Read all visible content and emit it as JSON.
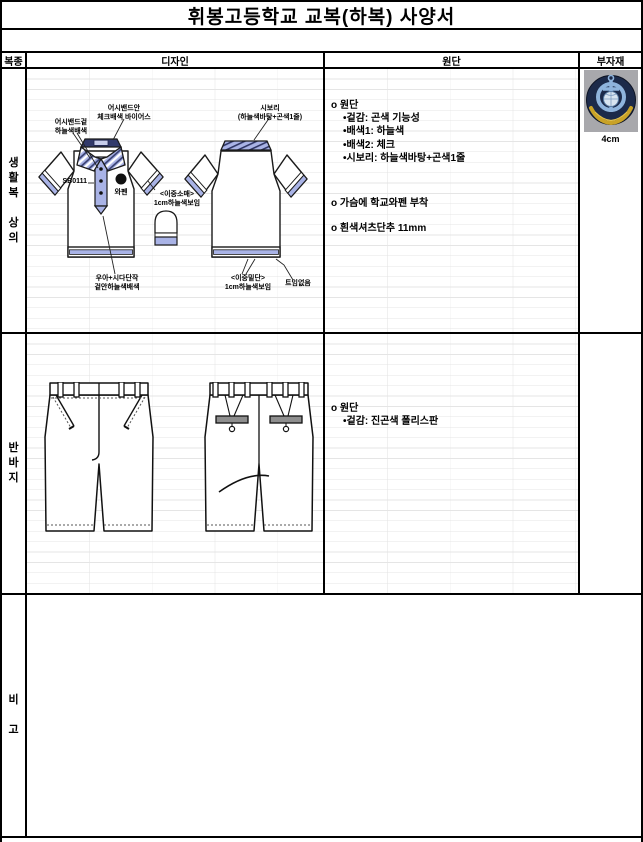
{
  "title": "휘봉고등학교 교복(하복) 사양서",
  "headers": {
    "category": "복종",
    "design": "디자인",
    "fabric": "원단",
    "materials": "부자재"
  },
  "rows": {
    "top": {
      "category": "생\n활\n복\n\n상\n의",
      "design": {
        "sb_code": "SB0111",
        "labels": {
          "collar_inner": "어시밴드안\n체크배색 바이어스",
          "collar_outer": "어시밴드겉\n하늘색배색",
          "sibori": "시보리\n(하늘색바탕+곤색1줄)",
          "wappen": "와펜",
          "double_sleeve": "<이중소매>\n1cm하늘색보임",
          "placket_bottom": "우아+시다단작\n겉안하늘색배색",
          "double_hem": "<이중밑단>\n1cm하늘색보임",
          "no_slit": "트임없음"
        }
      },
      "fabric": [
        "o 원단",
        "•겉감: 곤색 기능성",
        "•배색1: 하늘색",
        "•배색2: 체크",
        "•시보리: 하늘색바탕+곤색1줄"
      ],
      "fabric_extra": [
        "o 가슴에 학교와펜 부착",
        "o 흰색셔츠단추 11mm"
      ],
      "materials_size": "4cm"
    },
    "middle": {
      "category": "반\n바\n지",
      "fabric": [
        "o 원단",
        "•겉감: 진곤색 폴리스판"
      ]
    },
    "bottom": {
      "category": "비\n\n고"
    }
  },
  "colors": {
    "accent": "#a9b3e6",
    "navy": "#323a6b",
    "emblem_navy": "#1c2a4a",
    "emblem_gold": "#c9a227",
    "emblem_blue": "#8fb4dd"
  }
}
